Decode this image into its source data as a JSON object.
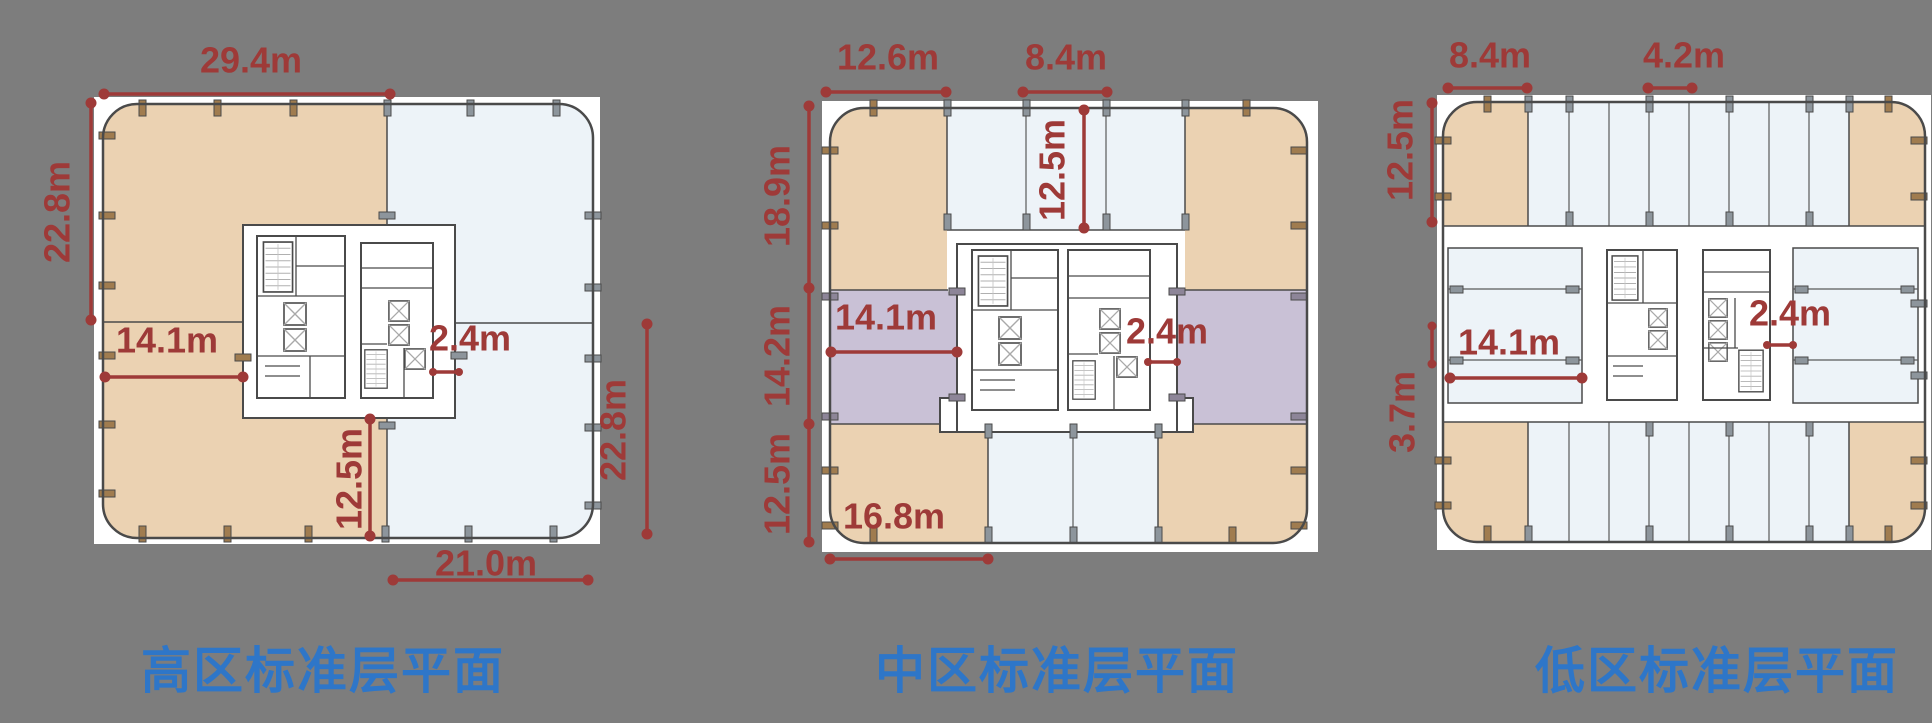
{
  "page": {
    "background_color": "#7d7d7d",
    "dimension_color": "#9e3a38",
    "title_color": "#2e76c8",
    "zone_colors": {
      "office_tan": "#ebd2b2",
      "bay_light_blue": "#edf3f8",
      "band_purple": "#c9c1d6"
    }
  },
  "plans": [
    {
      "id": "high-zone",
      "title": "高区标准层平面",
      "dims": {
        "top": "29.4m",
        "left": "22.8m",
        "inner_left": "14.1m",
        "core_gap": "2.4m",
        "core_to_edge": "12.5m",
        "right": "22.8m",
        "bottom": "21.0m"
      }
    },
    {
      "id": "mid-zone",
      "title": "中区标准层平面",
      "dims": {
        "top_left": "12.6m",
        "top_mid": "8.4m",
        "bay_depth": "12.5m",
        "left_upper": "18.9m",
        "left_mid": "14.2m",
        "left_lower": "12.5m",
        "inner_left": "14.1m",
        "core_gap": "2.4m",
        "bottom_left": "16.8m"
      }
    },
    {
      "id": "low-zone",
      "title": "低区标准层平面",
      "dims": {
        "top_left": "8.4m",
        "top_mid": "4.2m",
        "left_upper": "12.5m",
        "left_mid": "3.7m",
        "inner_left": "14.1m",
        "core_gap": "2.4m"
      }
    }
  ]
}
